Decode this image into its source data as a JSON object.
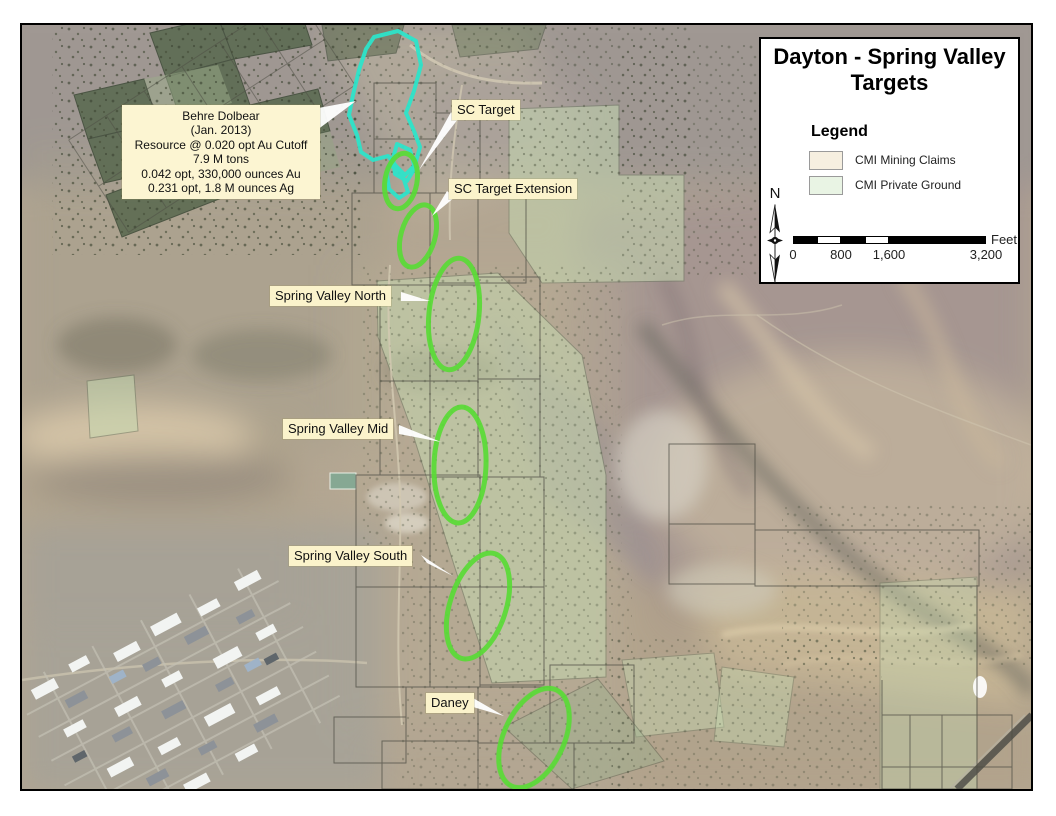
{
  "map": {
    "panel": {
      "title": "Dayton - Spring Valley Targets",
      "legend_heading": "Legend",
      "legend_items": [
        {
          "label": "CMI Mining Claims",
          "swatch_color": "#F6EFE0"
        },
        {
          "label": "CMI Private Ground",
          "swatch_color": "#E9F4E4"
        }
      ],
      "north_label": "N",
      "scale_bar": {
        "ticks": [
          "0",
          "800",
          "1,600",
          "3,200"
        ],
        "unit_label": "Feet"
      }
    },
    "annotation_box": {
      "lines": [
        "Behre Dolbear",
        "(Jan. 2013)",
        "Resource @ 0.020 opt Au Cutoff",
        "7.9 M tons",
        "0.042 opt, 330,000 ounces Au",
        "0.231 opt, 1.8 M ounces Ag"
      ]
    },
    "target_labels": [
      {
        "id": "sc-target",
        "label": "SC Target"
      },
      {
        "id": "sc-target-extension",
        "label": "SC Target Extension"
      },
      {
        "id": "spring-valley-north",
        "label": "Spring Valley North"
      },
      {
        "id": "spring-valley-mid",
        "label": "Spring Valley Mid"
      },
      {
        "id": "spring-valley-south",
        "label": "Spring Valley South"
      },
      {
        "id": "daney",
        "label": "Daney"
      }
    ],
    "colors": {
      "target_ellipse": "#59DB36",
      "resource_outline": "#2EE4CA",
      "label_background": "#FBF3CB",
      "mining_claims_swatch": "#F6EFE0",
      "private_ground_swatch": "#E9F4E4"
    }
  }
}
